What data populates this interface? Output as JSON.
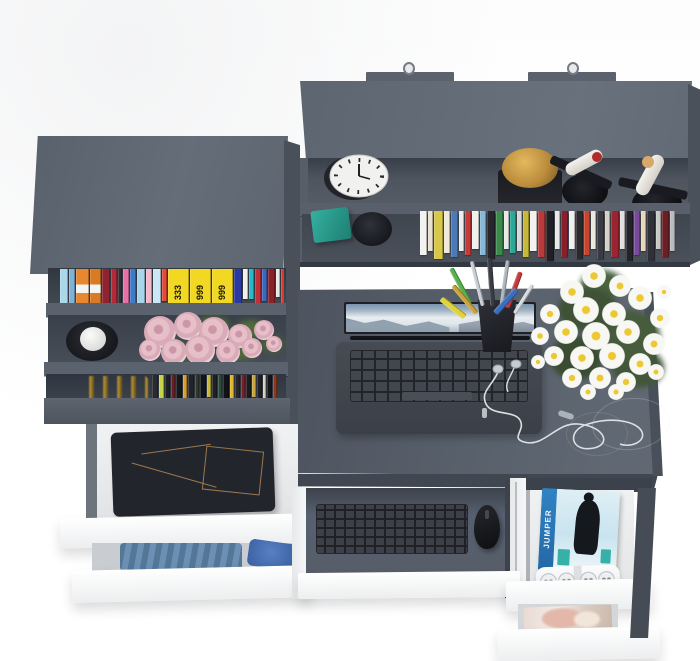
{
  "texts": {
    "jumper_spine": "JUMPER"
  },
  "palette": {
    "furniture_top": "#5e6671",
    "furniture_face": "#525963",
    "interior_shadow": "#3f454e",
    "white_drawer": "#f6f7f8",
    "desk_top": "#565d68",
    "jeans": "#23252d",
    "denim_light": "#5f87ad",
    "denim_bright": "#3a69b8",
    "teal_box": "#28a091",
    "trophy_gold": "#c0923e",
    "jumper_blue": "#2f83c4",
    "daisy_petal": "#f7f7f3",
    "daisy_center": "#eec832",
    "rose_pink": "#e6bfc9"
  },
  "wall_shelf": {
    "books": [
      {
        "c": "#f2f2f0",
        "w": 7,
        "h": 44
      },
      {
        "c": "#e8e0d0",
        "w": 5,
        "h": 40
      },
      {
        "c": "#d8c84a",
        "w": 9,
        "h": 48
      },
      {
        "c": "#f0ead8",
        "w": 6,
        "h": 42
      },
      {
        "c": "#4a7ab8",
        "w": 7,
        "h": 46
      },
      {
        "c": "#eceeee",
        "w": 5,
        "h": 40
      },
      {
        "c": "#c83a3a",
        "w": 6,
        "h": 44
      },
      {
        "c": "#f0f0ee",
        "w": 7,
        "h": 38
      },
      {
        "c": "#88b8d8",
        "w": 6,
        "h": 44
      },
      {
        "c": "#26262c",
        "w": 8,
        "h": 48
      },
      {
        "c": "#3a8a4a",
        "w": 7,
        "h": 44
      },
      {
        "c": "#e8e8e6",
        "w": 5,
        "h": 38
      },
      {
        "c": "#2aa898",
        "w": 6,
        "h": 42
      },
      {
        "c": "#d8d8d4",
        "w": 5,
        "h": 40
      },
      {
        "c": "#c8b83a",
        "w": 6,
        "h": 46
      },
      {
        "c": "#f2f2f0",
        "w": 7,
        "h": 40
      },
      {
        "c": "#b83a3a",
        "w": 7,
        "h": 46
      },
      {
        "c": "#1f1f24",
        "w": 8,
        "h": 50
      },
      {
        "c": "#e8e8e8",
        "w": 5,
        "h": 38
      },
      {
        "c": "#8a1f2a",
        "w": 7,
        "h": 46
      },
      {
        "c": "#f0f0ee",
        "w": 6,
        "h": 38
      },
      {
        "c": "#2a2a2e",
        "w": 7,
        "h": 48
      },
      {
        "c": "#c8442a",
        "w": 6,
        "h": 44
      },
      {
        "c": "#ece8e0",
        "w": 5,
        "h": 38
      },
      {
        "c": "#3a3a40",
        "w": 7,
        "h": 48
      },
      {
        "c": "#d8d0c0",
        "w": 5,
        "h": 40
      },
      {
        "c": "#9a2430",
        "w": 8,
        "h": 46
      },
      {
        "c": "#e0e0de",
        "w": 5,
        "h": 38
      },
      {
        "c": "#23242a",
        "w": 7,
        "h": 50
      },
      {
        "c": "#7a4a9a",
        "w": 6,
        "h": 44
      },
      {
        "c": "#e8d8b8",
        "w": 5,
        "h": 40
      },
      {
        "c": "#303038",
        "w": 8,
        "h": 50
      },
      {
        "c": "#c8c8c4",
        "w": 5,
        "h": 38
      },
      {
        "c": "#6a1f26",
        "w": 7,
        "h": 46
      },
      {
        "c": "#b8bcc0",
        "w": 5,
        "h": 40
      }
    ]
  },
  "bookshelf": {
    "top_books": [
      {
        "c": "#aad8e8",
        "w": 8,
        "h": 34
      },
      {
        "c": "#7fb2d4",
        "w": 6,
        "h": 38
      },
      {
        "c": "#e8872f",
        "w": 13,
        "h": 46,
        "band": "#f4f4f2"
      },
      {
        "c": "#d97a24",
        "w": 11,
        "h": 46,
        "band": "#f4f4f2"
      },
      {
        "c": "#8f2430",
        "w": 8,
        "h": 42
      },
      {
        "c": "#b02a38",
        "w": 6,
        "h": 40
      },
      {
        "c": "#2f2f35",
        "w": 4,
        "h": 38
      },
      {
        "c": "#e870a8",
        "w": 6,
        "h": 36
      },
      {
        "c": "#3f7cc8",
        "w": 6,
        "h": 34
      },
      {
        "c": "#a8d4ec",
        "w": 8,
        "h": 40
      },
      {
        "c": "#f0b8c8",
        "w": 6,
        "h": 34
      },
      {
        "c": "#c8e8f4",
        "w": 8,
        "h": 38
      },
      {
        "c": "#e8483a",
        "w": 5,
        "h": 32
      },
      {
        "c": "#f2d822",
        "w": 21,
        "h": 48,
        "t": "333"
      },
      {
        "c": "#f2d822",
        "w": 21,
        "h": 48,
        "t": "999"
      },
      {
        "c": "#f2d822",
        "w": 21,
        "h": 48,
        "t": "999"
      },
      {
        "c": "#2a3aa2",
        "w": 8,
        "h": 36
      },
      {
        "c": "#f0f0ee",
        "w": 5,
        "h": 30
      },
      {
        "c": "#28b8c8",
        "w": 5,
        "h": 30
      },
      {
        "c": "#c03038",
        "w": 6,
        "h": 36
      },
      {
        "c": "#3a68c0",
        "w": 5,
        "h": 32
      },
      {
        "c": "#8a2028",
        "w": 7,
        "h": 38
      },
      {
        "c": "#e8e8e6",
        "w": 4,
        "h": 28
      },
      {
        "c": "#d83a2e",
        "w": 6,
        "h": 34
      }
    ],
    "bottom_books": [
      {
        "c": "#2a2b31",
        "w": 6,
        "h": 26
      },
      {
        "c": "#c6d44a",
        "w": 5,
        "h": 24
      },
      {
        "c": "#1f2025",
        "w": 5,
        "h": 27
      },
      {
        "c": "#6a1f26",
        "w": 4,
        "h": 25
      },
      {
        "c": "#17181c",
        "w": 6,
        "h": 26
      },
      {
        "c": "#d8a02a",
        "w": 4,
        "h": 23
      },
      {
        "c": "#23242a",
        "w": 6,
        "h": 27
      },
      {
        "c": "#2f3a2a",
        "w": 4,
        "h": 24
      },
      {
        "c": "#13141a",
        "w": 6,
        "h": 26
      },
      {
        "c": "#c8b83a",
        "w": 4,
        "h": 22
      },
      {
        "c": "#1f2026",
        "w": 5,
        "h": 27
      },
      {
        "c": "#2a4a3a",
        "w": 4,
        "h": 24
      },
      {
        "c": "#101218",
        "w": 6,
        "h": 26
      },
      {
        "c": "#e0b62a",
        "w": 4,
        "h": 23
      },
      {
        "c": "#26272d",
        "w": 5,
        "h": 27
      },
      {
        "c": "#7a2028",
        "w": 4,
        "h": 25
      },
      {
        "c": "#1b1c22",
        "w": 5,
        "h": 26
      },
      {
        "c": "#caa63a",
        "w": 4,
        "h": 22
      },
      {
        "c": "#202128",
        "w": 5,
        "h": 27
      },
      {
        "c": "#d8d0b8",
        "w": 3,
        "h": 23
      },
      {
        "c": "#15161c",
        "w": 5,
        "h": 26
      },
      {
        "c": "#8a3a20",
        "w": 4,
        "h": 24
      }
    ],
    "roses": [
      [
        20,
        20,
        16
      ],
      [
        48,
        14,
        14
      ],
      [
        74,
        20,
        15
      ],
      [
        100,
        24,
        12
      ],
      [
        124,
        18,
        10
      ],
      [
        10,
        38,
        11
      ],
      [
        34,
        40,
        13
      ],
      [
        60,
        38,
        15
      ],
      [
        88,
        40,
        12
      ],
      [
        112,
        36,
        10
      ],
      [
        134,
        32,
        8
      ]
    ],
    "rose_leaves": [
      {
        "x": 6,
        "y": 10,
        "w": 30,
        "h": 22,
        "c": "#55703f"
      },
      {
        "x": 56,
        "y": 4,
        "w": 34,
        "h": 20,
        "c": "#4c6639"
      },
      {
        "x": 96,
        "y": 8,
        "w": 30,
        "h": 18,
        "c": "#516c3c"
      },
      {
        "x": 30,
        "y": 30,
        "w": 36,
        "h": 20,
        "c": "#46603a"
      },
      {
        "x": 84,
        "y": 28,
        "w": 34,
        "h": 20,
        "c": "#50683e"
      },
      {
        "x": 120,
        "y": 24,
        "w": 24,
        "h": 16,
        "c": "#4a6238"
      }
    ]
  },
  "desk": {
    "pens": [
      {
        "x": 6,
        "y": 4,
        "w": 5,
        "l": 40,
        "r": -28,
        "c": "#57b04e"
      },
      {
        "x": 20,
        "y": 0,
        "w": 4,
        "l": 46,
        "r": -14,
        "c": "#c8cdd3"
      },
      {
        "x": 30,
        "y": -2,
        "w": 5,
        "l": 48,
        "r": -4,
        "c": "#3a3d44"
      },
      {
        "x": 40,
        "y": 0,
        "w": 4,
        "l": 46,
        "r": 8,
        "c": "#aeb4bc"
      },
      {
        "x": 12,
        "y": 18,
        "w": 5,
        "l": 36,
        "r": -40,
        "c": "#caa23a"
      },
      {
        "x": 46,
        "y": 10,
        "w": 5,
        "l": 38,
        "r": 20,
        "c": "#c23a3a"
      },
      {
        "x": 34,
        "y": 22,
        "w": 6,
        "l": 32,
        "r": 42,
        "c": "#3a6fc0"
      },
      {
        "x": 54,
        "y": 20,
        "w": 4,
        "l": 34,
        "r": 32,
        "c": "#d8dce0"
      },
      {
        "x": 0,
        "y": 28,
        "w": 6,
        "l": 30,
        "r": -52,
        "c": "#e0d23a"
      }
    ],
    "daisies": [
      [
        66,
        14,
        12
      ],
      [
        92,
        24,
        11
      ],
      [
        44,
        30,
        12
      ],
      [
        112,
        36,
        12
      ],
      [
        22,
        52,
        10
      ],
      [
        58,
        48,
        13
      ],
      [
        86,
        52,
        12
      ],
      [
        132,
        56,
        10
      ],
      [
        12,
        74,
        9
      ],
      [
        38,
        70,
        12
      ],
      [
        68,
        74,
        14
      ],
      [
        100,
        70,
        12
      ],
      [
        126,
        82,
        11
      ],
      [
        26,
        94,
        10
      ],
      [
        54,
        96,
        12
      ],
      [
        84,
        94,
        13
      ],
      [
        112,
        102,
        11
      ],
      [
        44,
        116,
        10
      ],
      [
        72,
        116,
        11
      ],
      [
        98,
        120,
        10
      ],
      [
        128,
        110,
        8
      ],
      [
        60,
        130,
        8
      ],
      [
        88,
        130,
        8
      ],
      [
        136,
        30,
        7
      ],
      [
        10,
        100,
        7
      ]
    ],
    "foliage": [
      {
        "x": 30,
        "y": 26,
        "w": 60,
        "h": 44,
        "c": "#3f5236"
      },
      {
        "x": 66,
        "y": 48,
        "w": 66,
        "h": 52,
        "c": "#465c3c"
      },
      {
        "x": 22,
        "y": 74,
        "w": 52,
        "h": 44,
        "c": "#3a4c32"
      },
      {
        "x": 84,
        "y": 86,
        "w": 52,
        "h": 40,
        "c": "#42563a"
      },
      {
        "x": 52,
        "y": 8,
        "w": 44,
        "h": 30,
        "c": "#4a6242"
      }
    ]
  }
}
